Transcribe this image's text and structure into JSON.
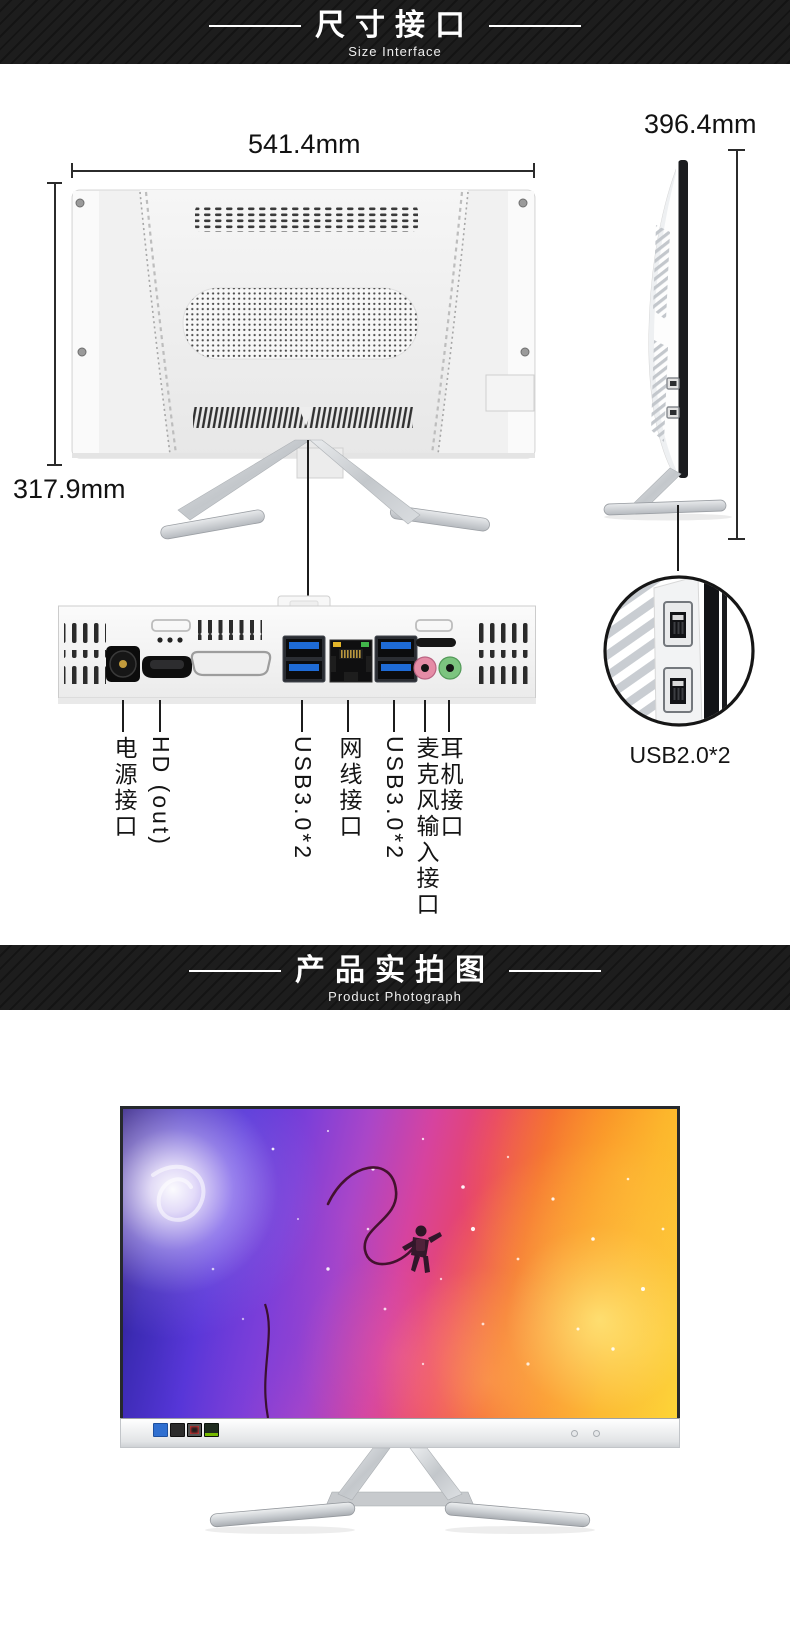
{
  "banners": {
    "size_interface": {
      "title": "尺寸接口",
      "subtitle": "Size Interface"
    },
    "product_photo": {
      "title": "产品实拍图",
      "subtitle": "Product Photograph"
    }
  },
  "dimensions": {
    "width": "541.4mm",
    "panel_height": "317.9mm",
    "total_height": "396.4mm"
  },
  "rear_ports": {
    "labels": [
      "电源接口",
      "HD (out)",
      "USB3.0*2",
      "网线接口",
      "USB3.0*2",
      "麦克风输入接口",
      "耳机接口"
    ]
  },
  "side_ports": {
    "usb_label": "USB2.0*2"
  },
  "colors": {
    "usb3_blue": "#1e6bd6",
    "mic_pink": "#e霁"
  }
}
